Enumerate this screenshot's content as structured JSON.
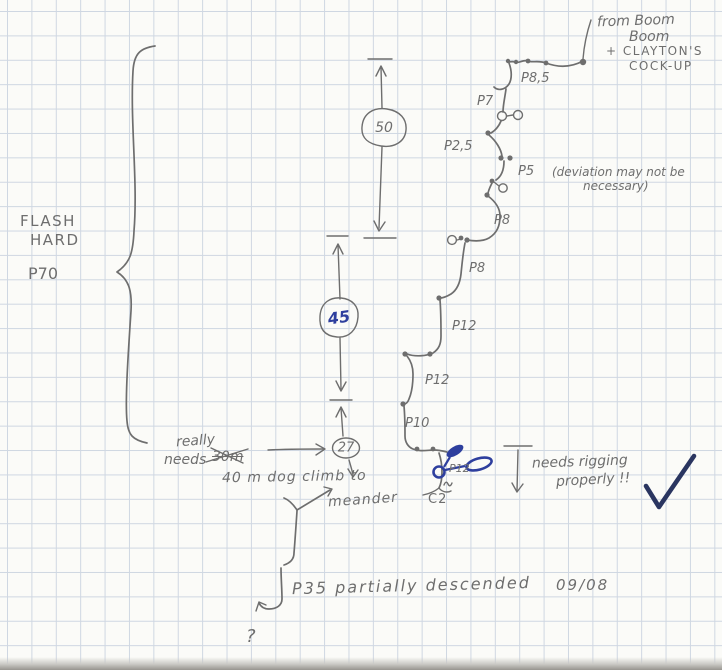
{
  "palette": {
    "pencil": "#6e6e6e",
    "ink": "#2e3f9e",
    "ink-dark": "#2a3560",
    "paper": "#fbfbf8",
    "grid": "#cfd7e2"
  },
  "origin_note": {
    "l1": "from Boom",
    "l2": "Boom",
    "l3": "+ CLAYTON'S",
    "l4": "COCK-UP"
  },
  "flash_note": {
    "l1": "FLASH",
    "l2": "HARD",
    "pitch": "P70"
  },
  "rope_lengths": {
    "r50": "50",
    "r45": "45",
    "r27": "27"
  },
  "pitches": {
    "p85": "P8,5",
    "p7": "P7",
    "p25": "P2,5",
    "p5": "P5",
    "p8a": "P8",
    "p8b": "P8",
    "p12a": "P12",
    "p12b": "P12",
    "p10": "P10",
    "p12c": "P12",
    "c2": "C2"
  },
  "deviation_note": {
    "l1": "(deviation may not be",
    "l2": "necessary)"
  },
  "climb_note": {
    "l1": "really",
    "l2": "needs",
    "struck": "30m",
    "l3": "40 m dog climb to",
    "l4": "meander"
  },
  "rigging_note": {
    "l1": "needs rigging",
    "l2": "properly !!"
  },
  "footer_note": {
    "text": "P35 partially descended",
    "date": "09/08"
  },
  "question": "?"
}
